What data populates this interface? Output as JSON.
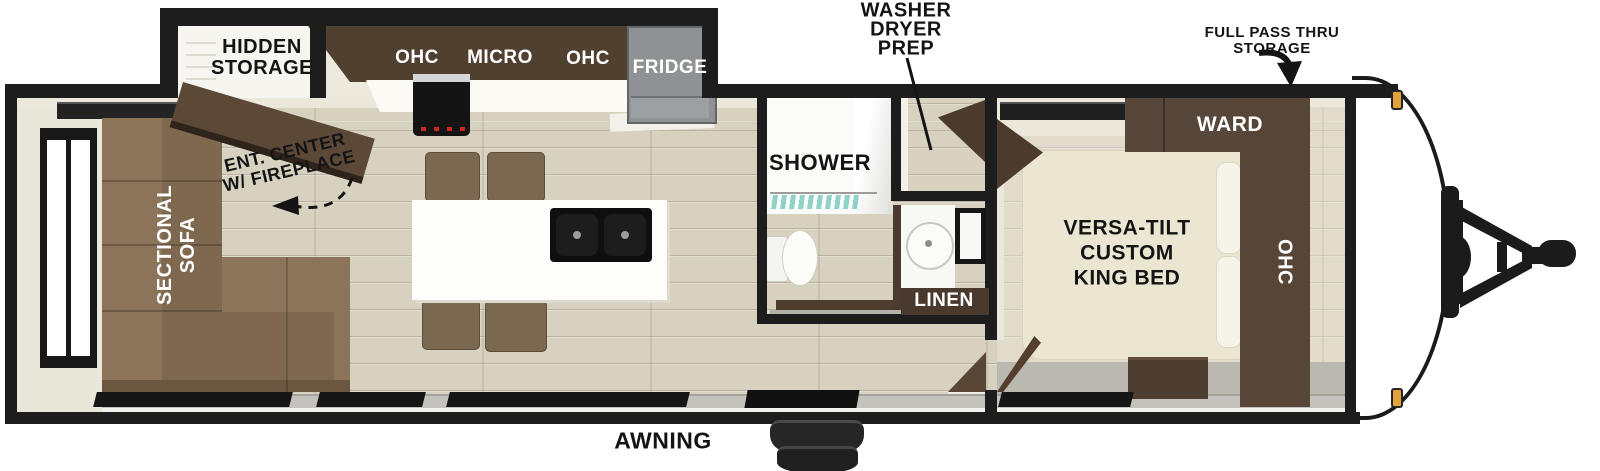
{
  "labels": {
    "hidden_storage_line1": "HIDDEN",
    "hidden_storage_line2": "STORAGE",
    "kitchen_ohc_left": "OHC",
    "kitchen_micro": "MICRO",
    "kitchen_ohc_right": "OHC",
    "fridge": "FRIDGE",
    "washer_line1": "WASHER",
    "washer_line2": "DRYER",
    "washer_line3": "PREP",
    "pass_thru_line1": "FULL PASS THRU",
    "pass_thru_line2": "STORAGE",
    "shower": "SHOWER",
    "linen": "LINEN",
    "ward": "WARD",
    "bedroom_ohc": "OHC",
    "bed_line1": "VERSA-TILT",
    "bed_line2": "CUSTOM",
    "bed_line3": "KING BED",
    "sofa_line1": "SECTIONAL",
    "sofa_line2": "SOFA",
    "ent_center_line1": "ENT. CENTER",
    "ent_center_line2": "W/ FIREPLACE",
    "awning": "AWNING"
  },
  "colors": {
    "wall_black": "#1d1d1d",
    "floor_beige": "#d7d1c0",
    "lining_cream": "#ebe8db",
    "cabinet_dark_brown": "#4e3d31",
    "ent_center_brown": "#5b4837",
    "sofa_brown": "#8b7459",
    "chair_brown": "#7b6850",
    "fridge_gray": "#8f9194",
    "island_white": "#fdfdfb",
    "bed_cream": "#ebe6d2",
    "shower_glass_teal": "#8fd2c8",
    "awning_gray": "#c3c2bc",
    "marker_light_orange": "#e2a23c"
  }
}
